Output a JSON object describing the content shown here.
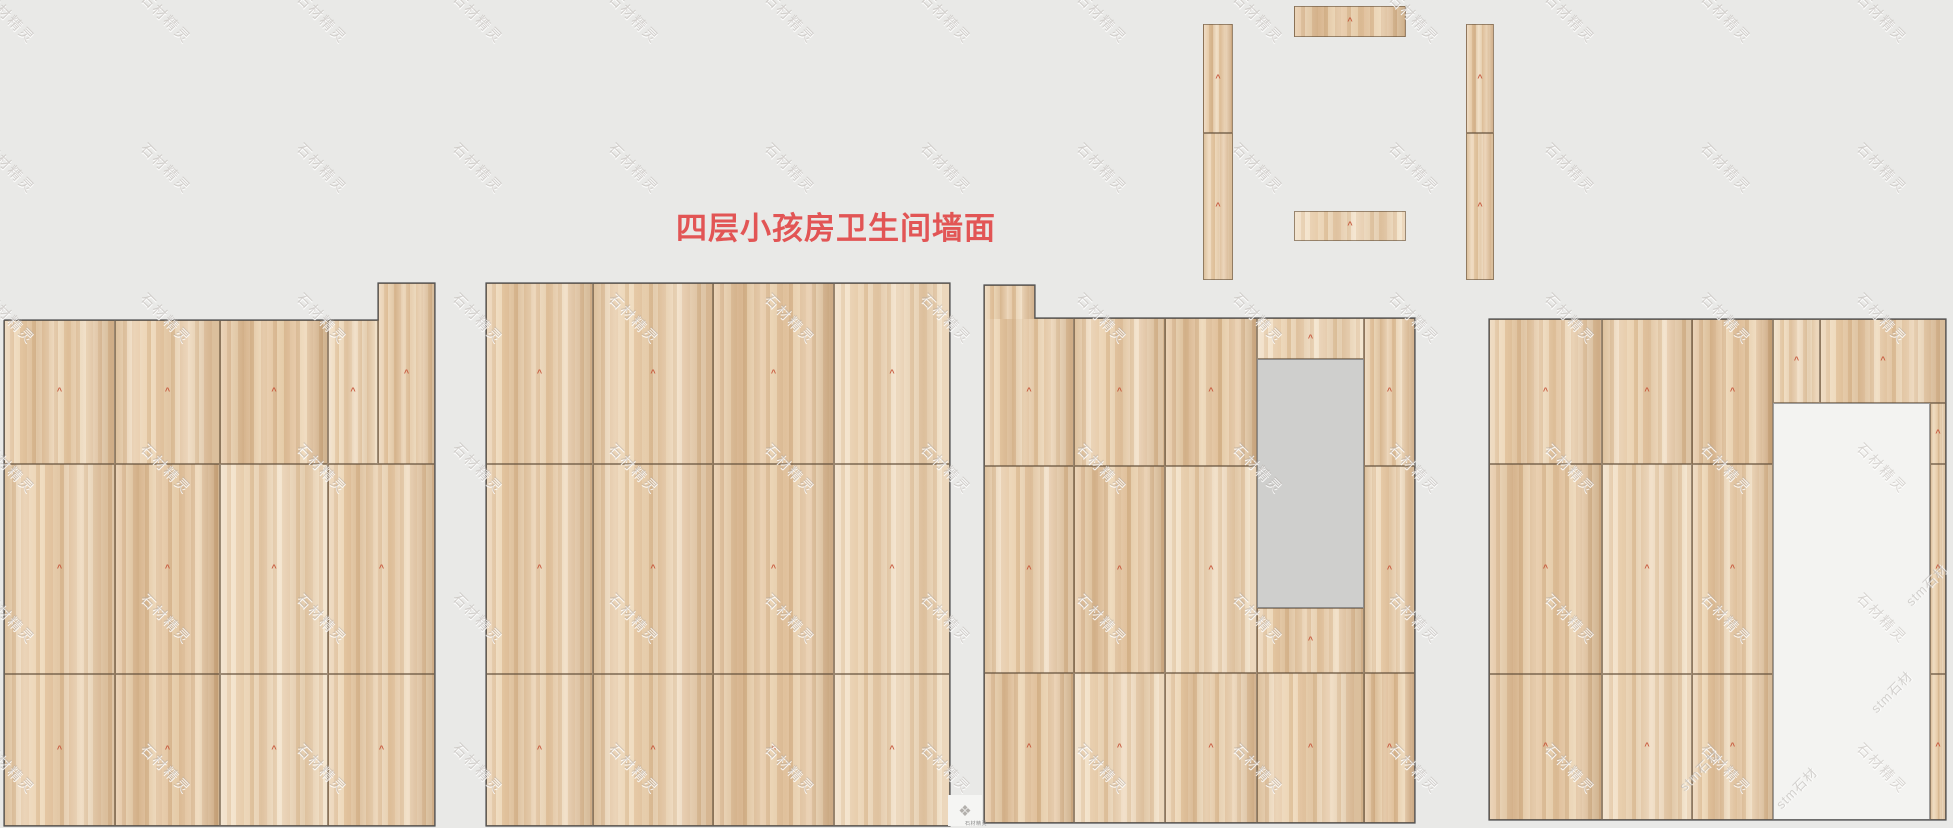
{
  "title": {
    "text": "四层小孩房卫生间墙面"
  },
  "mark_glyph": "^",
  "colors": {
    "background": "#e9e9e7",
    "wood_base": "#e3c6a2",
    "seam": "#64503c",
    "panel_outline": "#4f4f4f",
    "gray_opening": "#cfcfcd",
    "white_opening": "#f3f3f1",
    "center_mark": "#c6523a",
    "title_red": "#e25555",
    "watermark_gray": "#aca6a0"
  },
  "watermark": {
    "text": "石材精灵",
    "cols": 13,
    "rows": 6,
    "dx": 156,
    "dy": 150,
    "x0": -22,
    "y0": 8
  },
  "watermark2": {
    "text": "stm石材",
    "positions": [
      [
        1713,
        770
      ],
      [
        1810,
        788
      ],
      [
        1905,
        692
      ],
      [
        1940,
        585
      ]
    ]
  },
  "footer": {
    "logo": "❖",
    "micro_text": "石材精灵"
  },
  "panels": [
    {
      "id": "wall-panel-1",
      "outline": [
        [
          4,
          320
        ],
        [
          378,
          320
        ],
        [
          378,
          283
        ],
        [
          435,
          283
        ],
        [
          435,
          826
        ],
        [
          4,
          826
        ]
      ],
      "tiles": [
        {
          "r": [
            4,
            320,
            111,
            144
          ]
        },
        {
          "r": [
            115,
            320,
            105,
            144
          ]
        },
        {
          "r": [
            220,
            320,
            108,
            144
          ]
        },
        {
          "r": [
            328,
            320,
            50,
            144
          ]
        },
        {
          "r": [
            378,
            283,
            57,
            181
          ]
        },
        {
          "r": [
            4,
            464,
            111,
            210
          ]
        },
        {
          "r": [
            115,
            464,
            105,
            210
          ]
        },
        {
          "r": [
            220,
            464,
            108,
            210
          ]
        },
        {
          "r": [
            328,
            464,
            107,
            210
          ]
        },
        {
          "r": [
            4,
            674,
            111,
            152
          ]
        },
        {
          "r": [
            115,
            674,
            105,
            152
          ]
        },
        {
          "r": [
            220,
            674,
            108,
            152
          ]
        },
        {
          "r": [
            328,
            674,
            107,
            152
          ]
        }
      ]
    },
    {
      "id": "wall-panel-2",
      "outline": [
        [
          486,
          283
        ],
        [
          950,
          283
        ],
        [
          950,
          826
        ],
        [
          486,
          826
        ]
      ],
      "tiles": [
        {
          "r": [
            486,
            283,
            107,
            181
          ]
        },
        {
          "r": [
            593,
            283,
            120,
            181
          ]
        },
        {
          "r": [
            713,
            283,
            121,
            181
          ]
        },
        {
          "r": [
            834,
            283,
            116,
            181
          ]
        },
        {
          "r": [
            486,
            464,
            107,
            210
          ]
        },
        {
          "r": [
            593,
            464,
            120,
            210
          ]
        },
        {
          "r": [
            713,
            464,
            121,
            210
          ]
        },
        {
          "r": [
            834,
            464,
            116,
            210
          ]
        },
        {
          "r": [
            486,
            674,
            107,
            152
          ]
        },
        {
          "r": [
            593,
            674,
            120,
            152
          ]
        },
        {
          "r": [
            713,
            674,
            121,
            152
          ]
        },
        {
          "r": [
            834,
            674,
            116,
            152
          ]
        }
      ]
    },
    {
      "id": "wall-panel-3",
      "outline": [
        [
          984,
          285
        ],
        [
          1035,
          285
        ],
        [
          1035,
          318
        ],
        [
          1415,
          318
        ],
        [
          1415,
          823
        ],
        [
          984,
          823
        ]
      ],
      "tiles": [
        {
          "r": [
            984,
            285,
            51,
            34
          ],
          "v": 0,
          "nomark": true,
          "tab": true
        },
        {
          "r": [
            984,
            318,
            90,
            148
          ],
          "v": 0
        },
        {
          "r": [
            1074,
            318,
            91,
            148
          ],
          "v": 1
        },
        {
          "r": [
            1165,
            318,
            92,
            148
          ],
          "v": 2
        },
        {
          "r": [
            1257,
            318,
            107,
            41
          ],
          "v": 3
        },
        {
          "r": [
            1364,
            318,
            51,
            148
          ],
          "v": 0
        },
        {
          "r": [
            984,
            466,
            90,
            207
          ],
          "v": 1
        },
        {
          "r": [
            1074,
            466,
            91,
            207
          ],
          "v": 2
        },
        {
          "r": [
            1165,
            466,
            92,
            207
          ],
          "v": 3
        },
        {
          "r": [
            1257,
            608,
            107,
            65
          ],
          "v": 0
        },
        {
          "r": [
            1364,
            466,
            51,
            207
          ],
          "v": 1
        },
        {
          "r": [
            984,
            673,
            90,
            150
          ],
          "v": 2
        },
        {
          "r": [
            1074,
            673,
            91,
            150
          ],
          "v": 3
        },
        {
          "r": [
            1165,
            673,
            92,
            150
          ],
          "v": 0
        },
        {
          "r": [
            1257,
            673,
            107,
            150
          ],
          "v": 1
        },
        {
          "r": [
            1364,
            673,
            51,
            150
          ],
          "v": 2
        }
      ],
      "cutouts": [
        {
          "r": [
            1257,
            359,
            107,
            249
          ],
          "kind": "gray"
        }
      ]
    },
    {
      "id": "wall-panel-4",
      "outline": [
        [
          1489,
          319
        ],
        [
          1946,
          319
        ],
        [
          1946,
          820
        ],
        [
          1489,
          820
        ]
      ],
      "tiles": [
        {
          "r": [
            1489,
            319,
            113,
            145
          ]
        },
        {
          "r": [
            1602,
            319,
            90,
            145
          ]
        },
        {
          "r": [
            1692,
            319,
            81,
            145
          ]
        },
        {
          "r": [
            1773,
            319,
            47,
            84
          ]
        },
        {
          "r": [
            1820,
            319,
            126,
            84
          ]
        },
        {
          "r": [
            1930,
            403,
            16,
            61
          ]
        },
        {
          "r": [
            1489,
            464,
            113,
            210
          ]
        },
        {
          "r": [
            1602,
            464,
            90,
            210
          ]
        },
        {
          "r": [
            1692,
            464,
            81,
            210
          ]
        },
        {
          "r": [
            1930,
            464,
            16,
            210
          ]
        },
        {
          "r": [
            1489,
            674,
            113,
            146
          ]
        },
        {
          "r": [
            1602,
            674,
            90,
            146
          ]
        },
        {
          "r": [
            1692,
            674,
            81,
            146
          ]
        },
        {
          "r": [
            1930,
            674,
            16,
            146
          ]
        }
      ],
      "cutouts": [
        {
          "r": [
            1773,
            403,
            157,
            417
          ],
          "kind": "white"
        }
      ]
    },
    {
      "id": "door-frame-strips",
      "outline": null,
      "tiles": [
        {
          "r": [
            1203,
            24,
            30,
            109
          ]
        },
        {
          "r": [
            1203,
            133,
            30,
            147
          ]
        },
        {
          "r": [
            1294,
            6,
            112,
            31
          ]
        },
        {
          "r": [
            1294,
            211,
            112,
            30
          ]
        },
        {
          "r": [
            1466,
            24,
            28,
            109
          ]
        },
        {
          "r": [
            1466,
            133,
            28,
            147
          ]
        }
      ]
    }
  ]
}
